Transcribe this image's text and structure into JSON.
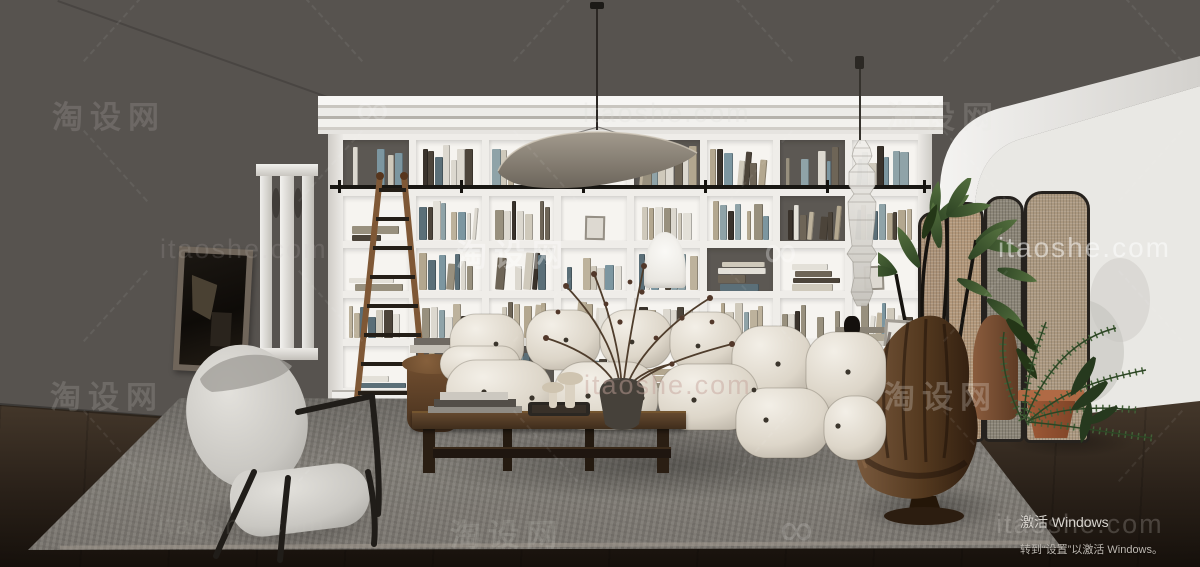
{
  "watermark": {
    "brand": "淘设网",
    "domain": "itaoshe.com",
    "logo_glyph": "∞",
    "instances": [
      {
        "kind": "brand",
        "x": 52,
        "y": 92,
        "size": 31,
        "color": "#e8e5e1",
        "opacity": 0.15
      },
      {
        "kind": "logo",
        "x": 356,
        "y": 82,
        "size": 46,
        "color": "#ffffff",
        "opacity": 0.18
      },
      {
        "kind": "domain",
        "x": 583,
        "y": 98,
        "size": 27,
        "color": "#d8d5d1",
        "opacity": 0.2
      },
      {
        "kind": "brand",
        "x": 886,
        "y": 92,
        "size": 31,
        "color": "#e8e5e1",
        "opacity": 0.16
      },
      {
        "kind": "domain",
        "x": 160,
        "y": 234,
        "size": 27,
        "color": "#cfccc8",
        "opacity": 0.15
      },
      {
        "kind": "brand",
        "x": 456,
        "y": 230,
        "size": 31,
        "color": "#ffffff",
        "opacity": 0.36
      },
      {
        "kind": "logo",
        "x": 764,
        "y": 224,
        "size": 46,
        "color": "#ffffff",
        "opacity": 0.3
      },
      {
        "kind": "domain",
        "x": 998,
        "y": 232,
        "size": 28,
        "color": "#ffffff",
        "opacity": 0.5
      },
      {
        "kind": "brand",
        "x": 50,
        "y": 372,
        "size": 31,
        "color": "#e8e5e1",
        "opacity": 0.16
      },
      {
        "kind": "domain",
        "x": 584,
        "y": 370,
        "size": 27,
        "color": "#c4a49a",
        "opacity": 0.48
      },
      {
        "kind": "brand",
        "x": 884,
        "y": 372,
        "size": 31,
        "color": "#efece8",
        "opacity": 0.25
      },
      {
        "kind": "domain",
        "x": 158,
        "y": 510,
        "size": 27,
        "color": "#cfccc8",
        "opacity": 0.12
      },
      {
        "kind": "brand",
        "x": 450,
        "y": 510,
        "size": 31,
        "color": "#e8e5e1",
        "opacity": 0.13
      },
      {
        "kind": "logo",
        "x": 780,
        "y": 502,
        "size": 46,
        "color": "#ffffff",
        "opacity": 0.15
      },
      {
        "kind": "domain",
        "x": 996,
        "y": 509,
        "size": 27,
        "color": "#efece8",
        "opacity": 0.2
      }
    ],
    "dash_lattice": {
      "xs": [
        115,
        330,
        545,
        760,
        975,
        1150
      ],
      "ys": [
        25,
        165,
        305,
        445
      ],
      "length": 95,
      "angle": 48,
      "opacity": 0.07,
      "color": "#ffffff"
    }
  },
  "os_overlay": {
    "line1": "激活 Windows",
    "line2": "转到“设置”以激活 Windows。"
  },
  "palette": {
    "wall_dark": "#57534f",
    "wall_light": "#eae8e5",
    "floor": "#3a3027",
    "rug": "#86827c",
    "bookshelf": "#f1efeb",
    "sofa": "#e9e4db",
    "wood": "#523c28",
    "leather": "#5f4630",
    "rattan": "#b0977c",
    "plant": "#3f5733",
    "terracotta": "#a75f3d",
    "lamp_shade": "#857d72"
  },
  "bookshelf": {
    "cols": 8,
    "rows": 5,
    "seed": 20240521,
    "book_palette": [
      "#cfc9bb",
      "#bdb29c",
      "#98907e",
      "#6e6557",
      "#4c443a",
      "#8fa3a8",
      "#7c96a0",
      "#dcd8cf",
      "#39322b",
      "#b3a78f",
      "#e3e0d8",
      "#5b6f78"
    ]
  }
}
